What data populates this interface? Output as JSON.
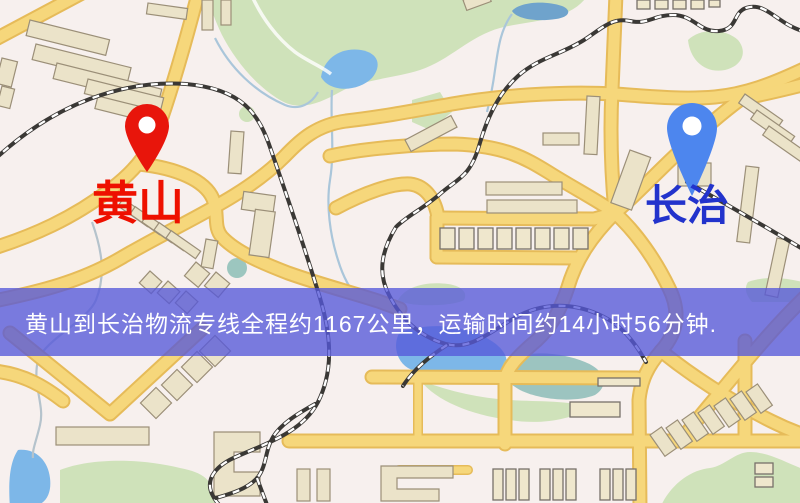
{
  "banner": {
    "text": "黄山到长治物流专线全程约1167公里，运输时间约14小时56分钟.",
    "background_color": "#5658da",
    "text_color": "#ffffff"
  },
  "markers": {
    "origin": {
      "label": "黄山",
      "label_color": "#ee1000",
      "pin_color": "#e8150b",
      "pin_icon": "map-pin"
    },
    "destination": {
      "label": "长治",
      "label_color": "#2233cc",
      "pin_color": "#4d86ee",
      "pin_icon": "map-pin"
    }
  },
  "map": {
    "colors": {
      "background": "#f7f0ee",
      "road_fill": "#f6d77b",
      "road_casing": "#e6bb59",
      "building": "#ebe3c9",
      "park_green": "#cfe2ba",
      "water_blue": "#7db7e8",
      "railway_dark": "#3a3835"
    }
  }
}
